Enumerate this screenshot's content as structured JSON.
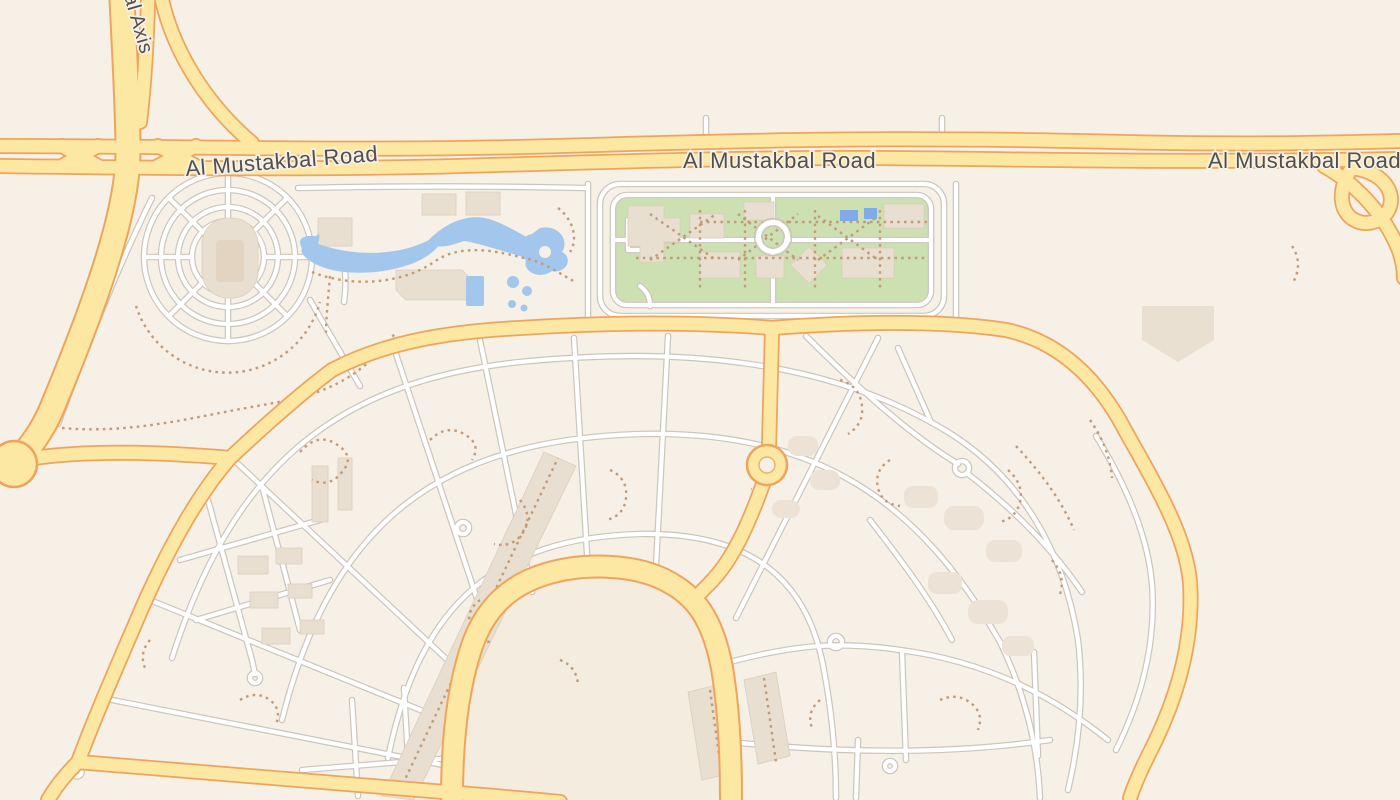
{
  "map": {
    "type": "street-map",
    "labels": {
      "vertical_road": "al Axis",
      "main_road_west": "Al Mustakbal Road",
      "main_road_center": "Al Mustakbal Road",
      "main_road_east": "Al Mustakbal Road"
    },
    "features": {
      "named_roads": [
        "Al Mustakbal Road",
        "al Axis"
      ],
      "visible_landmarks": [
        "stadium-grounds",
        "lagoon-water-park",
        "green-campus-with-roundabout",
        "fan-shaped-residential-district",
        "central-circular-plaza",
        "highway-interchange"
      ]
    },
    "palette": {
      "background": "#f6f0e6",
      "major_road_fill": "#fce8a3",
      "major_road_casing": "#efa45c",
      "minor_road_fill": "#ffffff",
      "minor_road_casing": "#cbc5bd",
      "park_green": "#cde0b2",
      "water_blue": "#a3c7ec",
      "building_fill": "#e9dfd0",
      "footpath_dots": "#c29b79",
      "label_text": "#52504a",
      "plaza_fill": "#f3ecdf"
    }
  }
}
